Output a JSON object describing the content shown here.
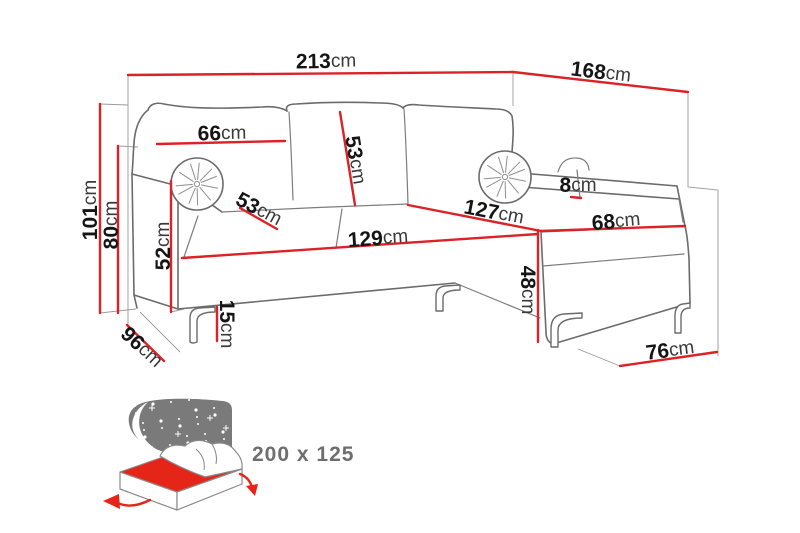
{
  "diagram": {
    "type": "furniture-dimension-diagram",
    "subject": "corner-sofa-bed",
    "colors": {
      "dimension_red": "#dc2127",
      "outline_gray": "#6b6b6b",
      "guide_gray": "#9a9a9a",
      "label_black": "#151515",
      "icon_gray": "#7a7a7a",
      "bed_red": "#e62519",
      "size_text_gray": "#6e6e6e"
    },
    "dimensions": [
      {
        "id": "width-total",
        "value": "213",
        "unit": "cm"
      },
      {
        "id": "depth-total",
        "value": "168",
        "unit": "cm"
      },
      {
        "id": "height-total",
        "value": "101",
        "unit": "cm"
      },
      {
        "id": "backrest-height",
        "value": "80",
        "unit": "cm"
      },
      {
        "id": "back-cushion-width",
        "value": "66",
        "unit": "cm"
      },
      {
        "id": "back-cushion-height",
        "value": "53",
        "unit": "cm"
      },
      {
        "id": "seat-depth",
        "value": "53",
        "unit": "cm"
      },
      {
        "id": "armrest-height",
        "value": "52",
        "unit": "cm"
      },
      {
        "id": "seat-width",
        "value": "129",
        "unit": "cm"
      },
      {
        "id": "chaise-length",
        "value": "127",
        "unit": "cm"
      },
      {
        "id": "chaise-width",
        "value": "68",
        "unit": "cm"
      },
      {
        "id": "back-panel-height",
        "value": "8",
        "unit": "cm"
      },
      {
        "id": "chaise-height",
        "value": "48",
        "unit": "cm"
      },
      {
        "id": "leg-height",
        "value": "15",
        "unit": "cm"
      },
      {
        "id": "side-depth",
        "value": "96",
        "unit": "cm"
      },
      {
        "id": "chaise-end-width",
        "value": "76",
        "unit": "cm"
      }
    ],
    "sleeping_area": {
      "size_label": "200 x 125"
    }
  }
}
